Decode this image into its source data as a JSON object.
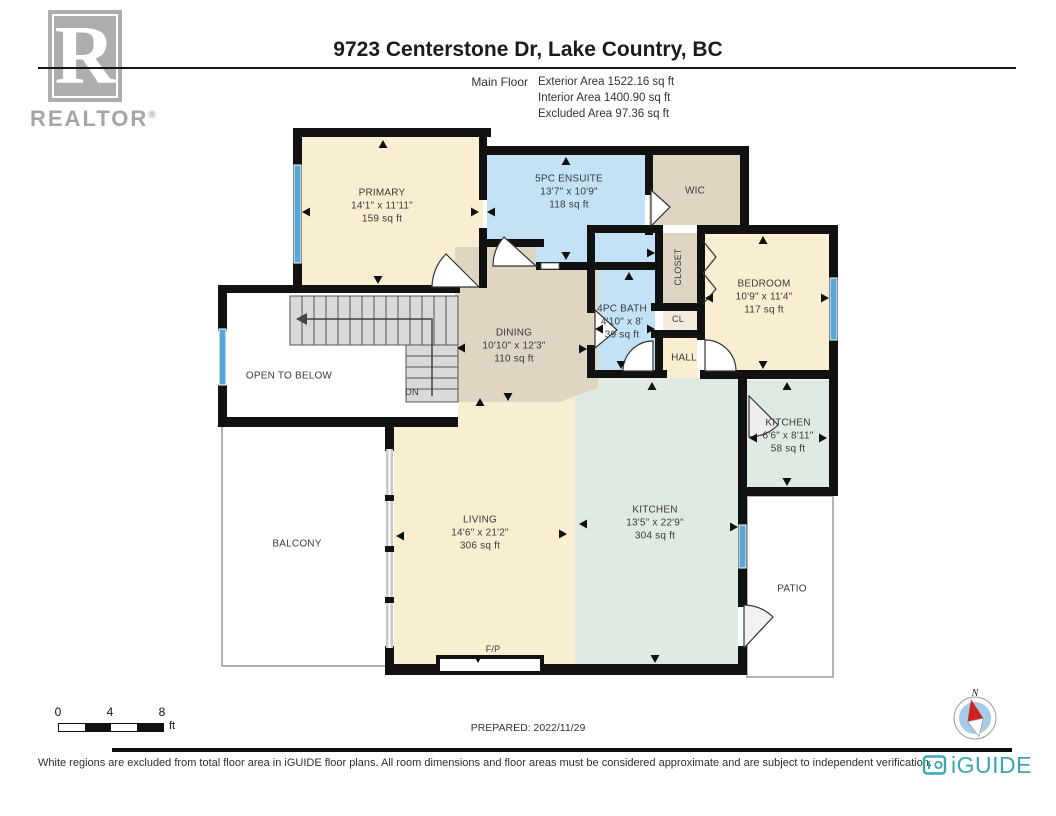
{
  "header": {
    "realtor_logo": {
      "letter": "R",
      "brand": "REALTOR",
      "registered": "®"
    },
    "title": "9723 Centerstone Dr, Lake Country, BC",
    "floor_label": "Main Floor",
    "areas": {
      "exterior": "Exterior Area 1522.16 sq ft",
      "interior": "Interior Area 1400.90 sq ft",
      "excluded": "Excluded Area 97.36 sq ft"
    }
  },
  "floorplan": {
    "rooms": [
      {
        "name": "PRIMARY",
        "dims": "14'1\" x 11'11\"",
        "area": "159 sq ft"
      },
      {
        "name": "5PC ENSUITE",
        "dims": "13'7\" x 10'9\"",
        "area": "118 sq ft"
      },
      {
        "name": "WIC"
      },
      {
        "name": "CLOSET"
      },
      {
        "name": "BEDROOM",
        "dims": "10'9\" x 11'4\"",
        "area": "117 sq ft"
      },
      {
        "name": "4PC BATH",
        "dims": "4'10\" x 8'",
        "area": "39 sq ft"
      },
      {
        "name": "CL"
      },
      {
        "name": "HALL"
      },
      {
        "name": "DINING",
        "dims": "10'10\" x 12'3\"",
        "area": "110 sq ft"
      },
      {
        "name": "OPEN TO BELOW"
      },
      {
        "name": "DN"
      },
      {
        "name": "BALCONY"
      },
      {
        "name": "LIVING",
        "dims": "14'6\" x 21'2\"",
        "area": "306 sq ft"
      },
      {
        "name": "KITCHEN",
        "dims": "13'5\" x 22'9\"",
        "area": "304 sq ft"
      },
      {
        "name": "KITCHEN",
        "dims": "6'6\" x 8'11\"",
        "area": "58 sq ft"
      },
      {
        "name": "PATIO"
      },
      {
        "name": "F/P"
      }
    ],
    "colors": {
      "wall": "#111111",
      "room_cream": "#faeed2",
      "room_blue": "#c3e2f6",
      "room_tan": "#ded5c3",
      "room_mint": "#dfeae3",
      "window_blue": "#56a7d8",
      "stairs_gray": "#d9d9d9"
    }
  },
  "footer_plan": {
    "scale": {
      "tick0": "0",
      "tick4": "4",
      "tick8": "8",
      "unit": "ft"
    },
    "prepared": "PREPARED: 2022/11/29",
    "compass_label": "N"
  },
  "footer": {
    "disclaimer": "White regions are excluded from total floor area in iGUIDE floor plans. All room dimensions and floor areas must be considered approximate and are subject to independent verification.",
    "brand": "iGUIDE",
    "brand_color": "#3aa7b5"
  }
}
